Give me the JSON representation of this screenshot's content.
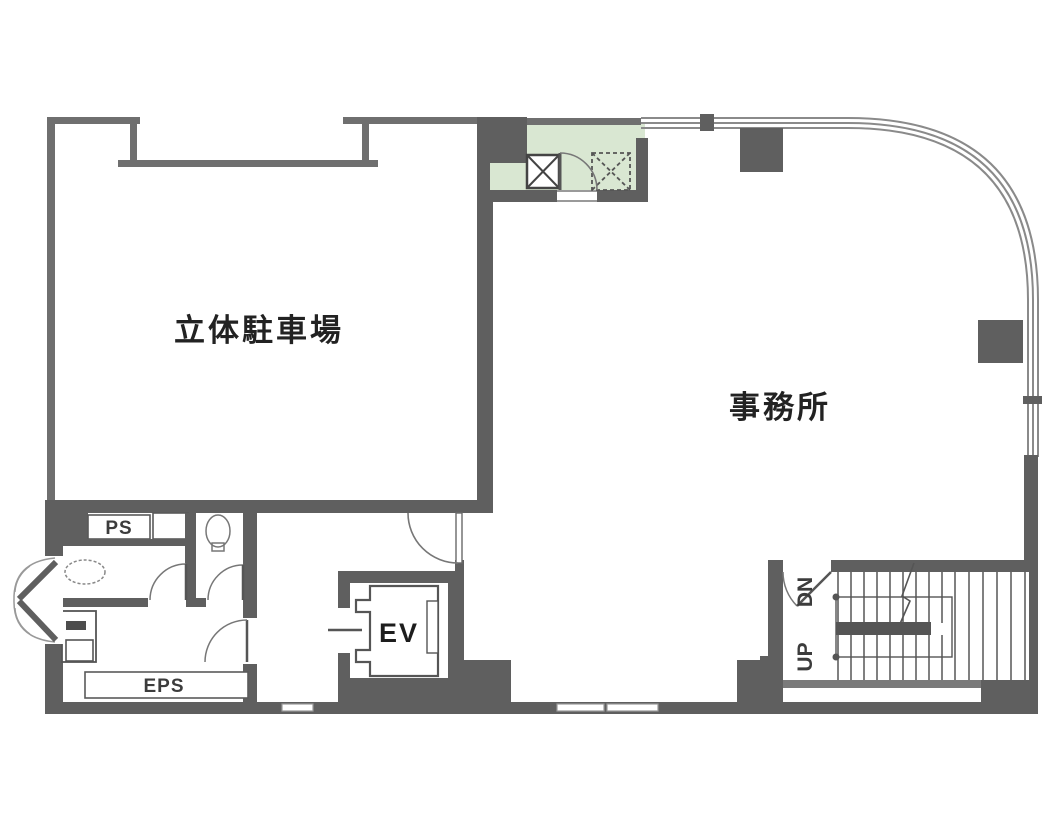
{
  "plan": {
    "rooms": {
      "parking": {
        "label": "立体駐車場"
      },
      "office": {
        "label": "事務所"
      },
      "pipe_shaft": {
        "label": "PS"
      },
      "electrical_pipe_shaft": {
        "label": "EPS"
      },
      "elevator": {
        "label": "EV"
      },
      "stairs": {
        "down": "DN",
        "up": "UP"
      }
    },
    "colors": {
      "wall_dark": "#5f5f5f",
      "wall_thin": "#6f6f6f",
      "service_core_green": "#d9e7d2",
      "floor_white": "#ffffff"
    },
    "symbols": [
      "solid-x-shaft-icon",
      "dashed-x-shaft-icon",
      "door-swing-arc-icon",
      "stair-treads-icon",
      "break-line-icon",
      "toilet-icon",
      "washbasin-icon"
    ]
  }
}
